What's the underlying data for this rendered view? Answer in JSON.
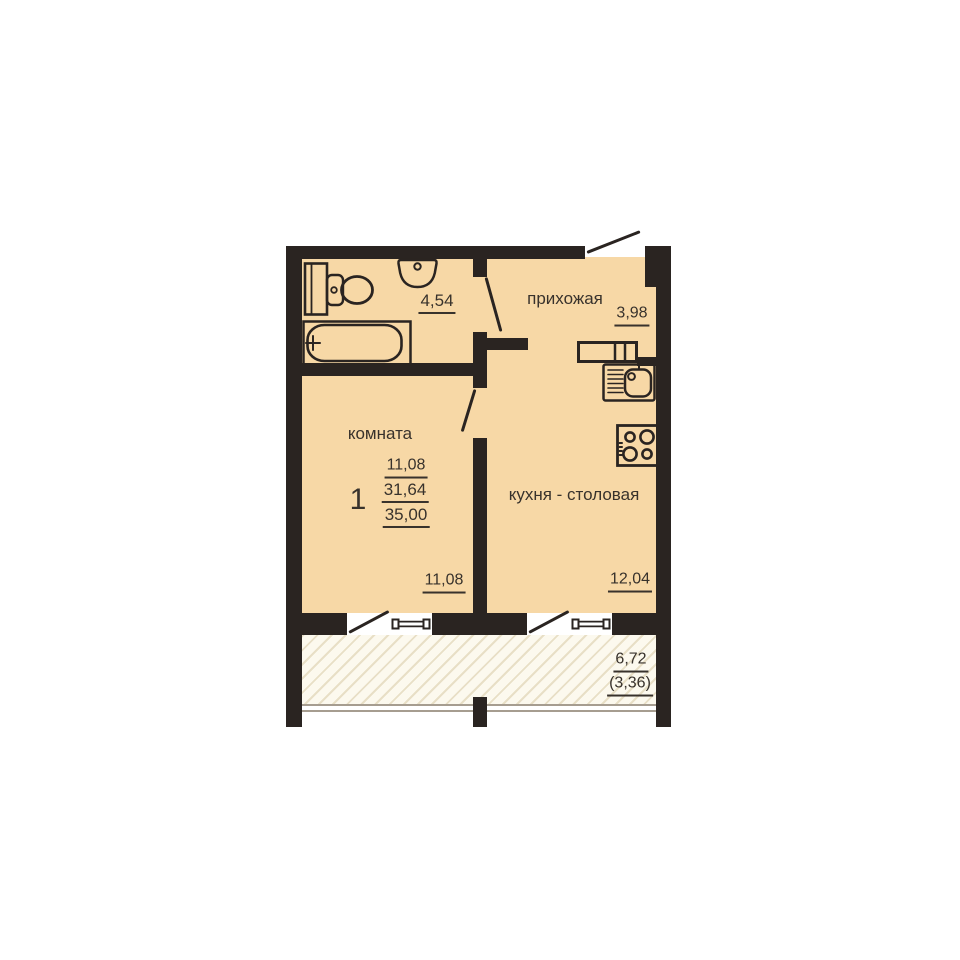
{
  "plan": {
    "type_label": "floor-plan",
    "rooms": {
      "hallway": {
        "label": "прихожая",
        "area": "3,98"
      },
      "bathroom": {
        "area": "4,54"
      },
      "living_room": {
        "label": "комната",
        "area": "11,08"
      },
      "kitchen_dining": {
        "label": "кухня - столовая",
        "area": "12,04"
      },
      "balcony": {
        "area": "6,72",
        "area_with_coefficient": "(3,36)"
      }
    },
    "apartment": {
      "rooms_count": "1",
      "living_area": "11,08",
      "area_without_balcony": "31,64",
      "total_area": "35,00"
    },
    "fixtures": [
      "toilet",
      "washbasin",
      "bathtub",
      "kitchen-counter",
      "kitchen-sink",
      "stove",
      "window",
      "door-swing"
    ],
    "colors": {
      "wall": "#2a2421",
      "floor": "#f7d8a6",
      "balcony_fill": "#fcf9ee",
      "balcony_hatch": "#e8dfc6",
      "text": "#38322c"
    }
  }
}
